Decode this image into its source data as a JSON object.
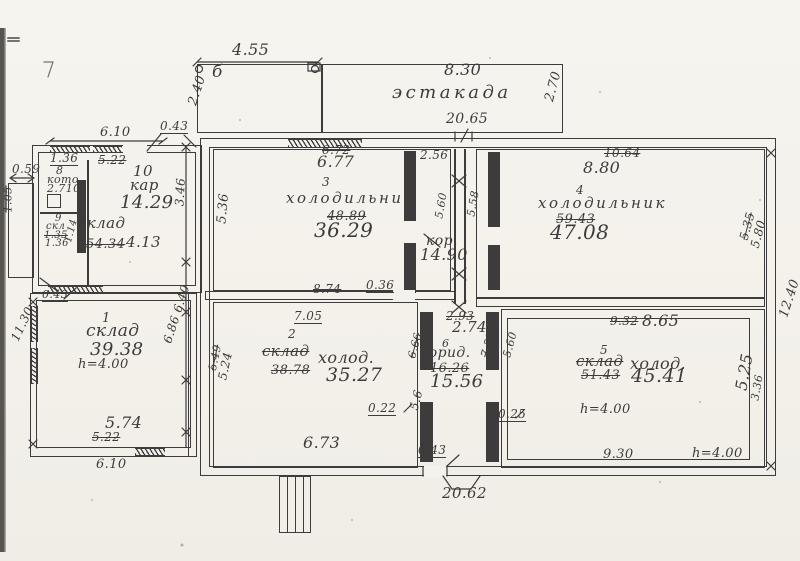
{
  "colors": {
    "paper": "#f4f2ec",
    "ink": "#3e3b3c"
  },
  "platform": {
    "name": "эстакада",
    "section_mark": "б",
    "dim_width_left": "4.55",
    "dim_width_right": "8.30",
    "dim_depth_left": "2.40",
    "dim_depth_right": "2.70",
    "dim_building_width": "20.65"
  },
  "building": {
    "dim_width_bottom": "20.62",
    "dim_height_right": "12.40",
    "dim_top_wall": "0.43",
    "dim_annex_top": "6.10",
    "dim_side_vertical": "3.46"
  },
  "annex": {
    "room10": {
      "number": "10",
      "name": "кар",
      "area": "14.29",
      "dim_door": "1.36",
      "dim_struck": "5.22"
    },
    "room8": {
      "number": "8",
      "name": "кото",
      "area": "2.710"
    },
    "room9": {
      "number": "9",
      "name": "скл",
      "dim1": "1.35",
      "dim2": "1.36",
      "dim_side": "1.14"
    },
    "storeroom": {
      "name": "склад",
      "area_struck": "54.34",
      "area": "4.13"
    },
    "porch": {
      "dim_width": "0.59",
      "dim_height": "1.05"
    }
  },
  "room1": {
    "number": "1",
    "name": "склад",
    "area": "39.38",
    "height": "h=4.00",
    "dim_left": "11.30",
    "dim_wall_top": "0.43",
    "dim_bottom": "5.74",
    "dim_bottom_struck": "5.22",
    "dim_outside_bottom": "6.10",
    "dim_right": "6.86 6.40"
  },
  "room3": {
    "number": "3",
    "name": "холодильник",
    "area": "36.29",
    "area_struck": "48.89",
    "dim_top": "6.77",
    "dim_top_struck": "6.72",
    "dim_left": "5.36",
    "dim_bottom_struck": "8.74",
    "dim_door": "0.36"
  },
  "corridor_upper": {
    "name": "кор.",
    "area": "14.90",
    "dim_top": "2.56",
    "dim_left": "5.60",
    "dim_right": "5.58"
  },
  "room4": {
    "number": "4",
    "name": "холодильник",
    "area": "47.08",
    "area_struck": "59.43",
    "dim_top": "8.80",
    "dim_top_struck": "10.64",
    "dim_right": "5.80",
    "dim_right_struck": "5.35"
  },
  "room2": {
    "number": "2",
    "name_struck": "склад",
    "name": "холод.",
    "area": "35.27",
    "area_struck": "38.78",
    "dim_top": "7.05",
    "dim_left": "5.24",
    "dim_left_struck": "5.49",
    "dim_bottom": "6.73",
    "dim_door": "0.22"
  },
  "corridor_lower": {
    "number": "6",
    "name": "корид.",
    "area": "15.56",
    "area_struck": "16.26",
    "dim_top": "2.74",
    "dim_top_struck": "2.93",
    "dim_left": "5.6",
    "dim_left_struck": "6.66",
    "dim_right": "5.60",
    "dim_right_struck": "7.52",
    "dim_door_right": "0.25",
    "dim_door_bottom": "0.43"
  },
  "room5": {
    "number": "5",
    "name_struck": "склад",
    "name": "холод.",
    "area": "45.41",
    "area_struck": "51.43",
    "dim_top": "8.65",
    "dim_top_struck": "9.32",
    "dim_right": "5.25",
    "dim_right2": "3.36",
    "dim_bottom": "9.30",
    "height": "h=4.00",
    "height_bottom": "h=4.00"
  }
}
